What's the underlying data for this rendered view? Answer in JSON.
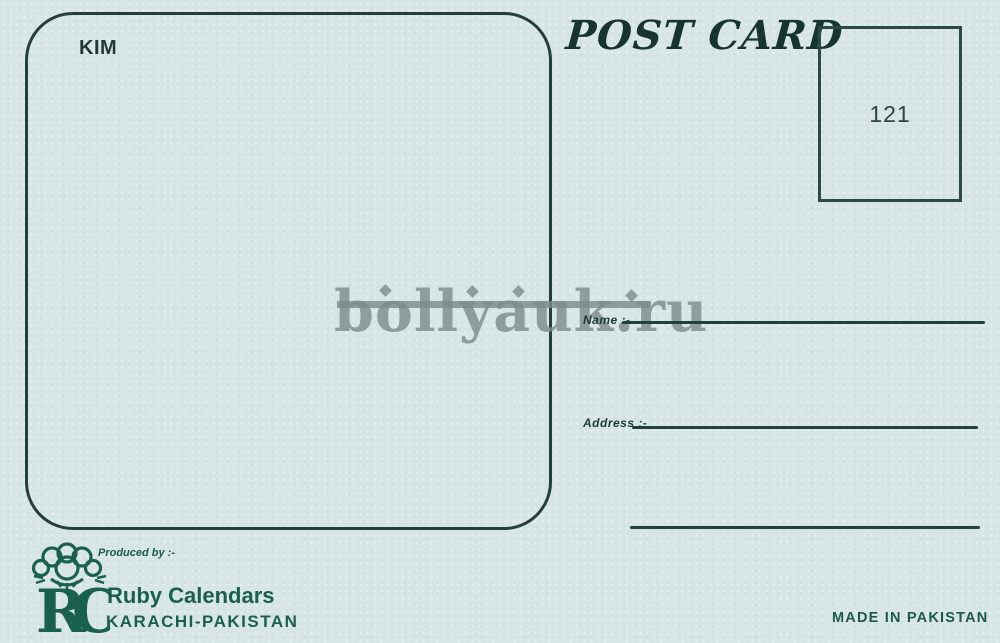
{
  "postcard": {
    "title": "POST CARD",
    "photo_caption": "KIM",
    "stamp_number": "121",
    "watermark": "bollyauk.ru",
    "fields": {
      "name_label": "Name :-",
      "address_label": "Address :-"
    },
    "producer": {
      "produced_by_label": "Produced by :-",
      "monogram": "RC",
      "company": "Ruby Calendars",
      "city": "KARACHI-PAKISTAN"
    },
    "origin": "MADE IN PAKISTAN",
    "colors": {
      "paper": "#d7e5e5",
      "ink": "#20403a",
      "brand_green": "#1a604e",
      "watermark_gray": "#7e8b8c"
    }
  }
}
